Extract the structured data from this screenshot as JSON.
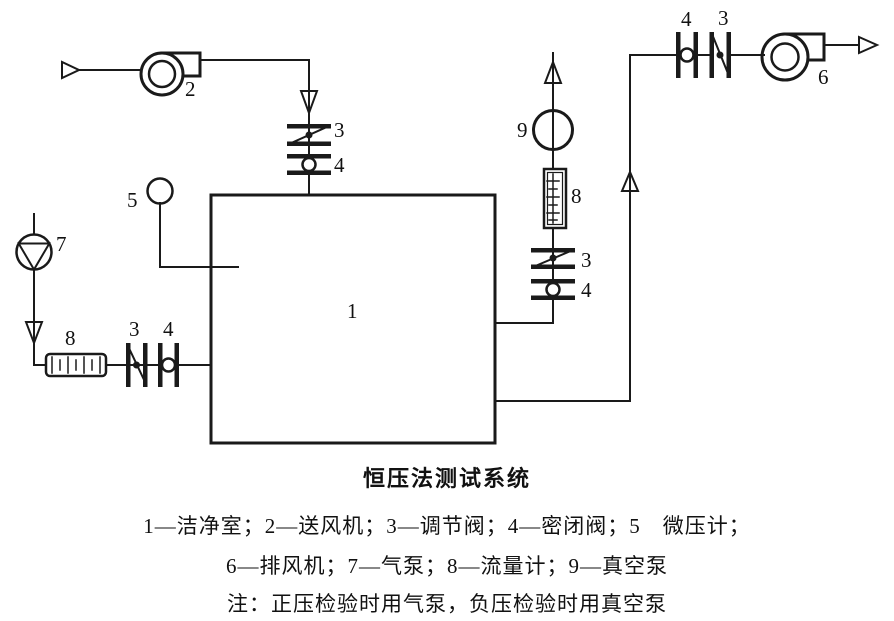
{
  "figure": {
    "labels": {
      "room": "1",
      "supply_fan": "2",
      "regulating_valve": "3",
      "sealing_valve": "4",
      "micro_pressure_gauge": "5",
      "exhaust_fan": "6",
      "air_pump": "7",
      "flow_meter": "8",
      "vacuum_pump": "9"
    },
    "title": "恒压法测试系统",
    "legend_line1": "1—洁净室；2—送风机；3—调节阀；4—密闭阀；5　微压计；",
    "legend_line2": "6—排风机；7—气泵；8—流量计；9—真空泵",
    "note": "注：正压检验时用气泵，负压检验时用真空泵",
    "colors": {
      "line": "#1a1a1a",
      "background": "#ffffff"
    }
  }
}
